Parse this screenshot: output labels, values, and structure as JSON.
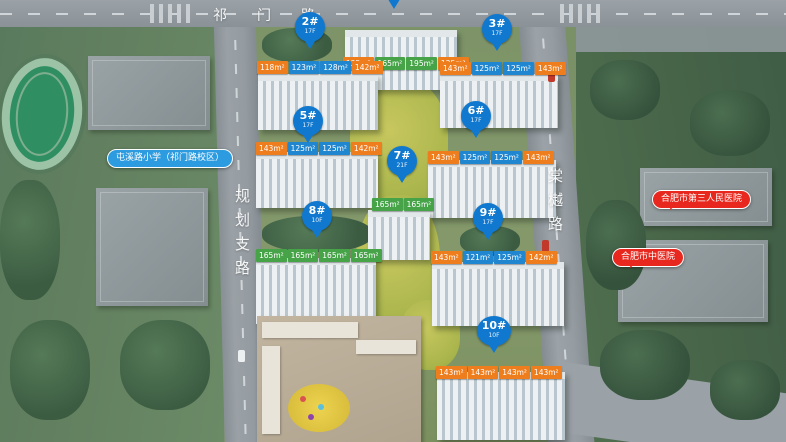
{
  "roads": {
    "top": "祁门路",
    "left": "规划支路",
    "right": "棠樾路"
  },
  "pois": {
    "school": "屯溪路小学（祁门路校区）",
    "hospital_third": "合肥市第三人民医院",
    "hospital_tcm": "合肥市中医院"
  },
  "colors": {
    "pin": "#1079cf",
    "tag_orange": "#ee7d1e",
    "tag_blue": "#1f86cf",
    "tag_green": "#46a348",
    "poi_blue": "#2d9bdf",
    "poi_red": "#e8281e"
  },
  "buildings": [
    {
      "id": "bldg-1",
      "pin": "",
      "floors": "",
      "tags": [
        {
          "t": "125m²",
          "c": "orange"
        },
        {
          "t": "165m²",
          "c": "green"
        },
        {
          "t": "195m²",
          "c": "green"
        },
        {
          "t": "125m²",
          "c": "orange"
        }
      ]
    },
    {
      "id": "bldg-2",
      "pin": "2#",
      "floors": "17F",
      "tags": [
        {
          "t": "118m²",
          "c": "orange"
        },
        {
          "t": "123m²",
          "c": "blue"
        },
        {
          "t": "128m²",
          "c": "blue"
        },
        {
          "t": "142m²",
          "c": "orange"
        }
      ]
    },
    {
      "id": "bldg-3",
      "pin": "3#",
      "floors": "17F",
      "tags": [
        {
          "t": "143m²",
          "c": "orange"
        },
        {
          "t": "125m²",
          "c": "blue"
        },
        {
          "t": "125m²",
          "c": "blue"
        },
        {
          "t": "143m²",
          "c": "orange"
        }
      ]
    },
    {
      "id": "bldg-5",
      "pin": "5#",
      "floors": "17F",
      "tags": [
        {
          "t": "143m²",
          "c": "orange"
        },
        {
          "t": "125m²",
          "c": "blue"
        },
        {
          "t": "125m²",
          "c": "blue"
        },
        {
          "t": "142m²",
          "c": "orange"
        }
      ]
    },
    {
      "id": "bldg-6",
      "pin": "6#",
      "floors": "17F",
      "tags": [
        {
          "t": "143m²",
          "c": "orange"
        },
        {
          "t": "125m²",
          "c": "blue"
        },
        {
          "t": "125m²",
          "c": "blue"
        },
        {
          "t": "143m²",
          "c": "orange"
        }
      ]
    },
    {
      "id": "bldg-7",
      "pin": "7#",
      "floors": "21F",
      "tags": [
        {
          "t": "165m²",
          "c": "green"
        },
        {
          "t": "165m²",
          "c": "green"
        }
      ]
    },
    {
      "id": "bldg-8",
      "pin": "8#",
      "floors": "10F",
      "tags": [
        {
          "t": "165m²",
          "c": "green"
        },
        {
          "t": "165m²",
          "c": "green"
        },
        {
          "t": "165m²",
          "c": "green"
        },
        {
          "t": "165m²",
          "c": "green"
        }
      ]
    },
    {
      "id": "bldg-9",
      "pin": "9#",
      "floors": "17F",
      "tags": [
        {
          "t": "143m²",
          "c": "orange"
        },
        {
          "t": "121m²",
          "c": "blue"
        },
        {
          "t": "125m²",
          "c": "blue"
        },
        {
          "t": "142m²",
          "c": "orange"
        }
      ]
    },
    {
      "id": "bldg-10",
      "pin": "10#",
      "floors": "10F",
      "tags": [
        {
          "t": "143m²",
          "c": "orange"
        },
        {
          "t": "143m²",
          "c": "orange"
        },
        {
          "t": "143m²",
          "c": "orange"
        },
        {
          "t": "143m²",
          "c": "orange"
        }
      ]
    }
  ]
}
